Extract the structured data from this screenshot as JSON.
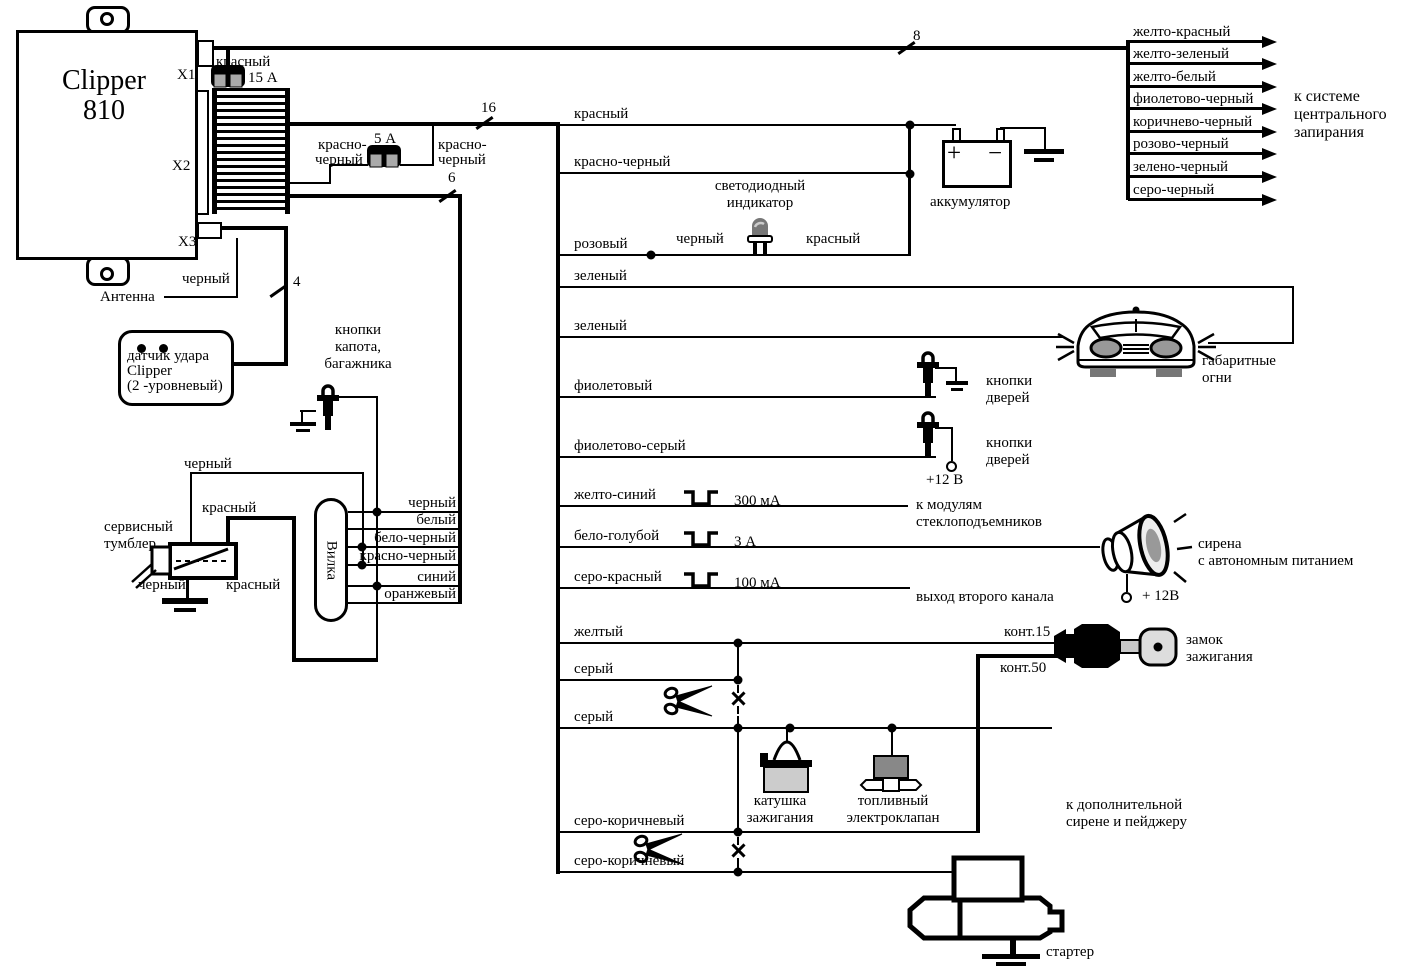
{
  "colors": {
    "ink": "#000000",
    "bg": "#ffffff",
    "pad_gray": "#aaaaaa",
    "light_gray": "#cccccc",
    "mid_gray": "#888888"
  },
  "unit": {
    "title": "Clipper",
    "model": "810",
    "conn1": "X1",
    "conn2": "X2",
    "conn3": "X3"
  },
  "counts": {
    "top_bus": "8",
    "main_bus": "16",
    "plug_bus": "6",
    "sensor_bus": "4"
  },
  "fuses": {
    "f15": "15 А",
    "f5": "5 А",
    "f15_wire": "красный",
    "f5_wire_l1": "красно-",
    "f5_wire_l2": "черный"
  },
  "antenna": {
    "label": "Антенна",
    "wire": "черный"
  },
  "shock_sensor": {
    "l1": "датчик удара",
    "l2": "Clipper",
    "l3": "(2 -уровневый)"
  },
  "hood_buttons": {
    "l1": "кнопки",
    "l2": "капота,",
    "l3": "багажника"
  },
  "central_lock": {
    "wires": [
      "желто-красный",
      "желто-зеленый",
      "желто-белый",
      "фиолетово-черный",
      "коричнево-черный",
      "розово-черный",
      "зелено-черный",
      "серо-черный"
    ],
    "t1": "к системе",
    "t2": "центрального",
    "t3": "запирания"
  },
  "battery": {
    "label": "аккумулятор",
    "plus": "+",
    "minus": "−"
  },
  "led": {
    "t1": "светодиодный",
    "t2": "индикатор",
    "wire_black": "черный",
    "wire_red": "красный"
  },
  "wires": {
    "red": "красный",
    "red_black": "красно-черный",
    "pink": "розовый",
    "green": "зеленый",
    "violet": "фиолетовый",
    "violet_gray": "фиолетово-серый",
    "yellow_blue": "желто-синий",
    "white_blue": "бело-голубой",
    "gray_red": "серо-красный",
    "yellow": "желтый",
    "gray": "серый",
    "gray_brown": "серо-коричневый"
  },
  "pulses": {
    "p1": "300 мА",
    "p2": "3 А",
    "p3": "100 мА"
  },
  "car": {
    "l1": "габаритные",
    "l2": "огни"
  },
  "door_buttons": {
    "l1": "кнопки",
    "l2": "дверей",
    "v12": "+12 В"
  },
  "windows": {
    "l1": "к модулям",
    "l2": "стеклоподъемников"
  },
  "siren": {
    "l1": "сирена",
    "l2": "с автономным питанием",
    "v12": "+ 12В"
  },
  "channel2": {
    "label": "выход второго канала"
  },
  "ignition_lock": {
    "k15": "конт.15",
    "k50": "конт.50",
    "l1": "замок",
    "l2": "зажигания"
  },
  "coil": {
    "l1": "катушка",
    "l2": "зажигания"
  },
  "valve": {
    "l1": "топливный",
    "l2": "электроклапан"
  },
  "aux": {
    "l1": "к дополнительной",
    "l2": "сирене и пейджеру"
  },
  "starter": {
    "label": "стартер"
  },
  "service": {
    "l1": "сервисный",
    "l2": "тумблер",
    "black": "черный",
    "red": "красный"
  },
  "plug": {
    "label": "Вилка",
    "wires": [
      "черный",
      "белый",
      "бело-черный",
      "красно-черный",
      "синий",
      "оранжевый"
    ]
  }
}
